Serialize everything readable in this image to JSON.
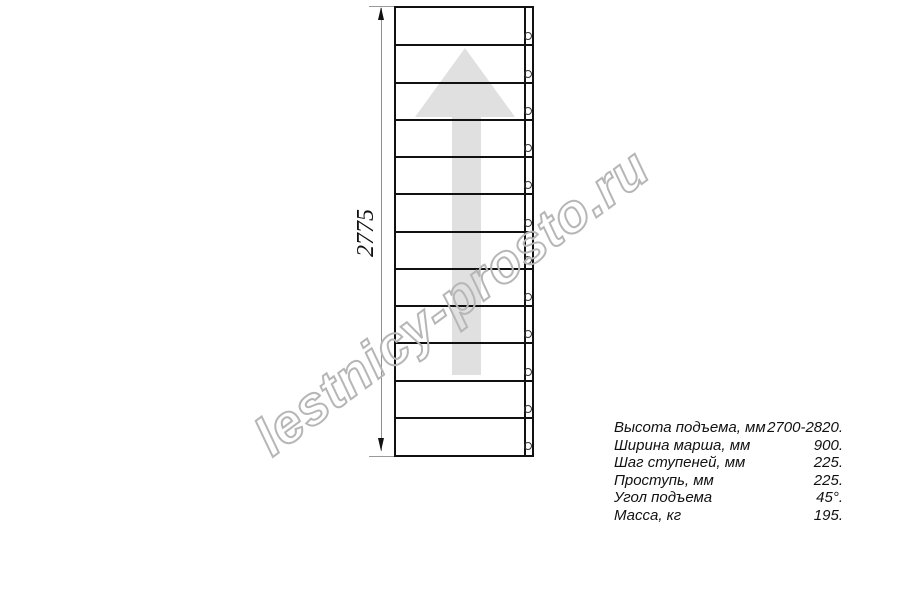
{
  "watermark": {
    "text": "lestnicy-prosto.ru",
    "color": "#b6b6b6"
  },
  "drawing": {
    "type": "straight-staircase-plan-view",
    "dimension_label": "2775",
    "steps_count": 12,
    "line_color": "#111111",
    "arrow_color": "#e0e0e0",
    "dim_line_color": "#8f8f8f"
  },
  "specs": {
    "rows": [
      {
        "label": "Высота подъема, мм",
        "value": "2700-2820."
      },
      {
        "label": "Ширина марша, мм",
        "value": "900."
      },
      {
        "label": "Шаг ступеней, мм",
        "value": "225."
      },
      {
        "label": "Проступь, мм",
        "value": "225."
      },
      {
        "label": "Угол подъема",
        "value": "45°."
      },
      {
        "label": "Масса, кг",
        "value": "195."
      }
    ]
  }
}
